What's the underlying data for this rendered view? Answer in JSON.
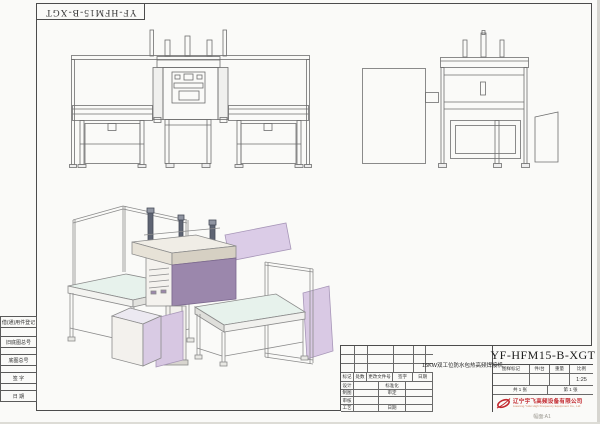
{
  "sheet": {
    "corner_stamp": "YF-HFM15-B-XGT",
    "footer_note": "幅面:A1"
  },
  "left_margin": {
    "labels": [
      "借(通)用件登记",
      "旧底图总号",
      "底图总号",
      "签  字",
      "日  期"
    ]
  },
  "revision_table": {
    "columns": [
      "标记",
      "处数",
      "更改文件号",
      "签字",
      "日期"
    ],
    "rows": [
      {
        "role": "设计",
        "right": "标准化"
      },
      {
        "role": "制图",
        "right": "审定"
      },
      {
        "role": "审核",
        "right": ""
      },
      {
        "role": "工艺",
        "right": "日期"
      }
    ]
  },
  "title_block": {
    "model": "YF-HFM15-B-XGT",
    "drawing_title": "15KW双工位防水包热高频焊接机",
    "header_mark": "图样标记",
    "header_per_unit": "件/台",
    "header_weight": "重量",
    "header_scale": "比例",
    "scale_value": "1:25",
    "sheet_total": "共 1 张",
    "sheet_number": "第 1 张",
    "company_cn": "辽宁宇飞高频设备有限公司",
    "company_en": "Liaoning Yufei High Frequency Equipment Co., Ltd"
  },
  "colors": {
    "panel_lavender": "#dbcce7",
    "panel_mauve": "#9b87ac",
    "table_top_cyan": "#e7f2ec",
    "line_gray": "#6e6e6e",
    "logo_red": "#c2272d"
  }
}
